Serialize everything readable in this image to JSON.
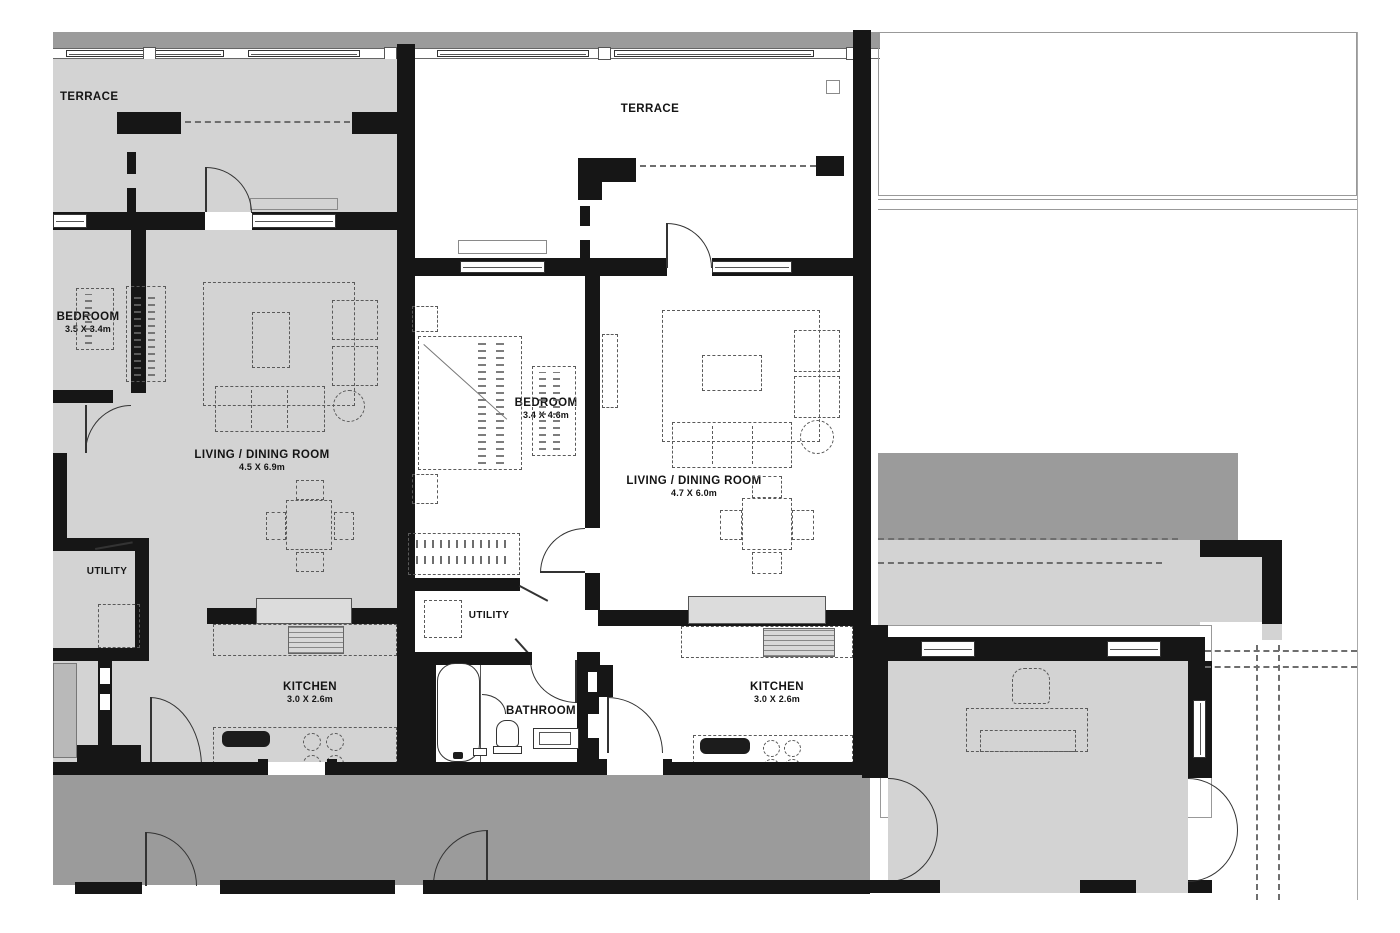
{
  "title": "Apartment floor plan",
  "colors": {
    "wall": "#161616",
    "room": "#d3d3d3",
    "balcony": "#9b9b9b",
    "outline": "#999999",
    "line": "#5a5a5a"
  },
  "rooms": {
    "terrace_left": {
      "name": "TERRACE"
    },
    "terrace_center": {
      "name": "TERRACE"
    },
    "bedroom_left": {
      "name": "BEDROOM",
      "dims": "3.5 X 3.4m"
    },
    "living_left": {
      "name": "LIVING / DINING ROOM",
      "dims": "4.5 X 6.9m"
    },
    "utility_left": {
      "name": "UTILITY"
    },
    "kitchen_left": {
      "name": "KITCHEN",
      "dims": "3.0 X 2.6m"
    },
    "bedroom_center": {
      "name": "BEDROOM",
      "dims": "3.4 X 4.6m"
    },
    "living_center": {
      "name": "LIVING / DINING ROOM",
      "dims": "4.7 X 6.0m"
    },
    "utility_center": {
      "name": "UTILITY"
    },
    "bathroom": {
      "name": "BATHROOM"
    },
    "kitchen_center": {
      "name": "KITCHEN",
      "dims": "3.0 X 2.6m"
    }
  }
}
